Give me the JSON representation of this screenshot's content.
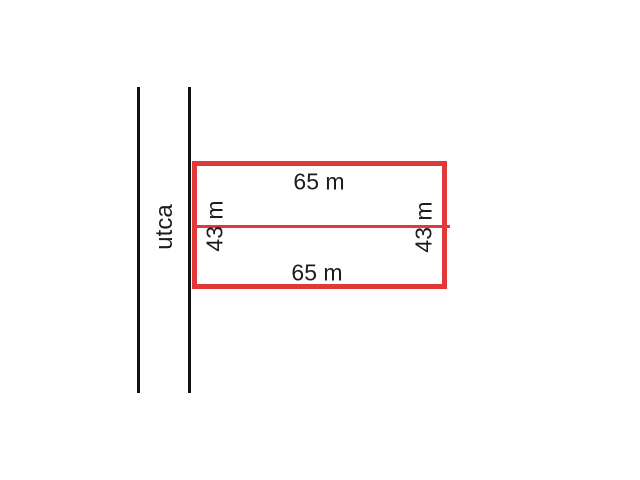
{
  "diagram": {
    "street_name": "utca",
    "plot": {
      "shape": "rectangle",
      "width_label": "65 m",
      "height_label": "43 m"
    },
    "dimensions": {
      "top": "65 m",
      "bottom": "65 m",
      "left": "43 m",
      "right": "43 m"
    }
  },
  "colors": {
    "plot_outline": "#e03a38",
    "street_line": "#111111",
    "text": "#1c1c1c",
    "background": "#ffffff"
  }
}
